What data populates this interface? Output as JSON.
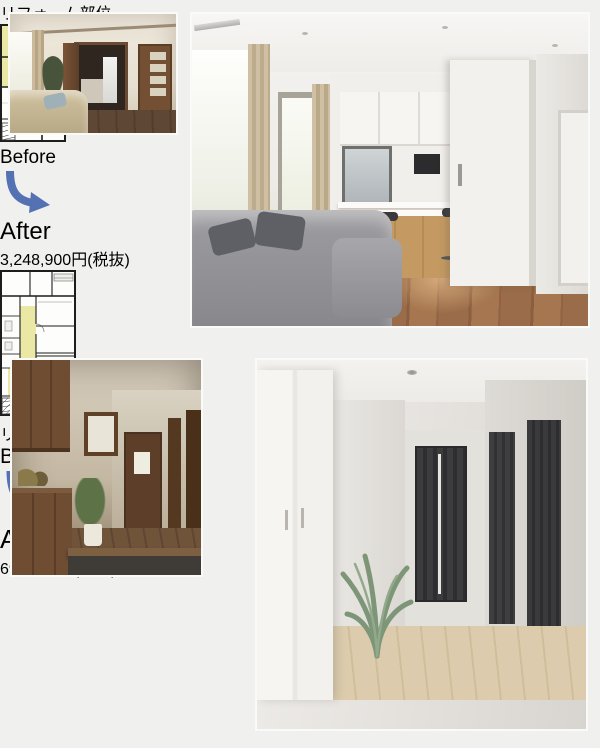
{
  "colors": {
    "page_bg": "#f0f0ee",
    "accent": "#5371b3",
    "price": "#3d63a8",
    "tax": "#3a3f48",
    "highlight": "#eae8a4"
  },
  "sections": [
    {
      "name": "living-dining-renovation",
      "plan_label": "リフォーム部位",
      "before_label": "Before",
      "after_label": "After",
      "price_value": "3,248,900",
      "price_unit": "円",
      "price_tax_note": "(税抜)"
    },
    {
      "name": "entrance-hallway-renovation",
      "plan_label": "リフォーム部位",
      "before_label": "Before",
      "after_label": "After",
      "price_value": "692,900",
      "price_unit": "円",
      "price_tax_note": "(税抜)"
    }
  ]
}
